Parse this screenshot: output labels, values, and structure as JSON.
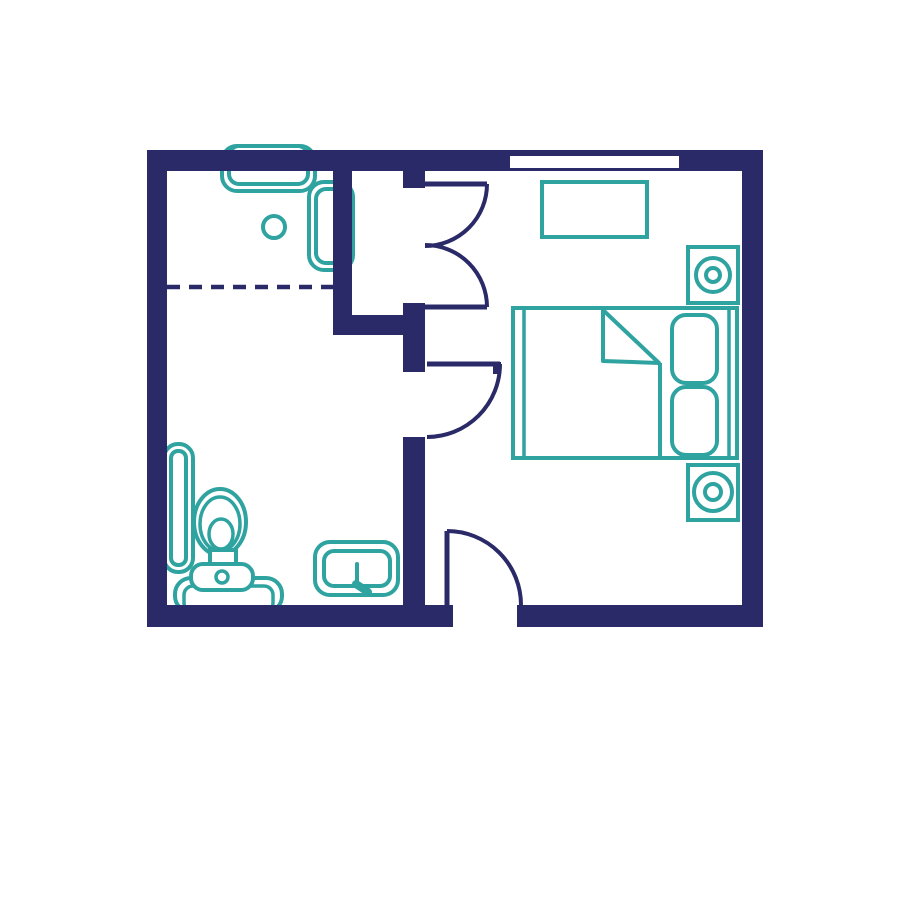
{
  "colors": {
    "background": "#ffffff",
    "wall": "#2b2a68",
    "fixture": "#2fa3a0"
  },
  "plan": {
    "type": "floor-plan",
    "rooms": [
      {
        "name": "bathroom",
        "fixtures": [
          "shower-enclosure",
          "shower-drain",
          "radiator",
          "toilet",
          "sink"
        ]
      },
      {
        "name": "closet",
        "fixtures": []
      },
      {
        "name": "bedroom",
        "fixtures": [
          "desk",
          "speaker-nightstand-top",
          "speaker-nightstand-bottom",
          "double-bed",
          "pillow",
          "pillow"
        ]
      }
    ],
    "openings": {
      "window_count": 1,
      "doors": [
        "closet-double-door",
        "bathroom-door",
        "entry-door"
      ]
    }
  }
}
